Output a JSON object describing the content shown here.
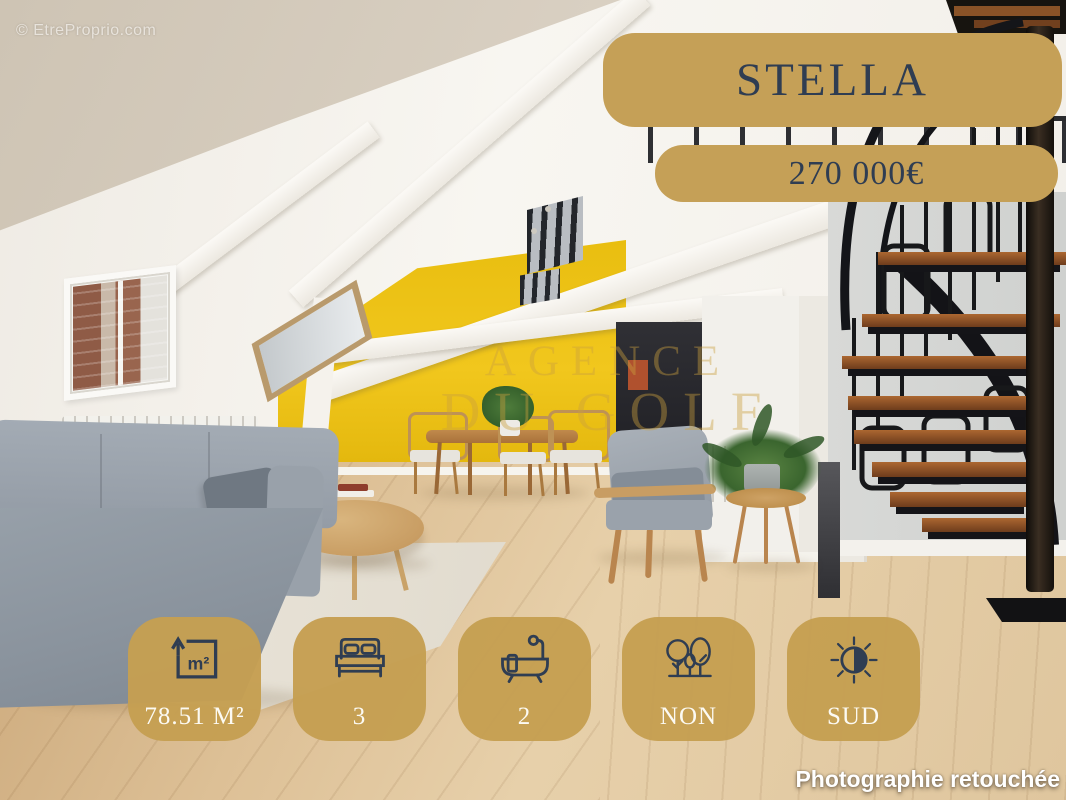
{
  "meta": {
    "site_watermark": "© EtreProprio.com",
    "retouched_label": "Photographie retouchée"
  },
  "listing": {
    "name": "STELLA",
    "price": "270 000€"
  },
  "agency_watermark": {
    "line1": "AGENCE",
    "line2": "DU GOLF"
  },
  "badges": [
    {
      "id": "surface",
      "icon": "area-m2-icon",
      "icon_label": "m²",
      "label": "78.51 M²"
    },
    {
      "id": "bedrooms",
      "icon": "bed-icon",
      "label": "3"
    },
    {
      "id": "bathrooms",
      "icon": "bath-icon",
      "label": "2"
    },
    {
      "id": "garden",
      "icon": "trees-icon",
      "label": "NON"
    },
    {
      "id": "exposure",
      "icon": "sun-icon",
      "label": "SUD"
    }
  ],
  "colors": {
    "badge_gold": "#C5A057",
    "badge_text_dark": "#2F3D52",
    "badge_text_light": "#FCFAF3",
    "accent_wall_yellow": "#EFC51C"
  }
}
